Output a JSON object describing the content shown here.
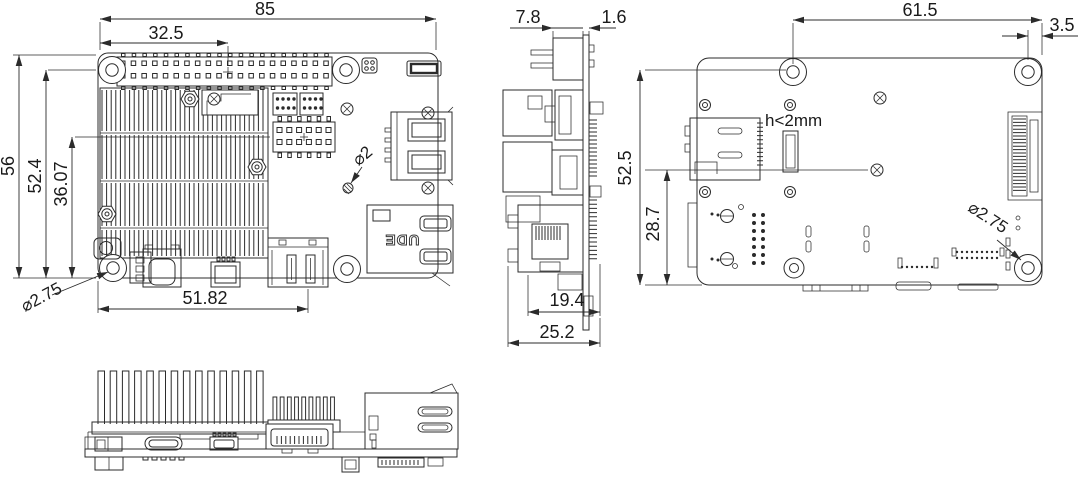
{
  "drawing": {
    "top_view": {
      "width": "85",
      "gpio_center_offset": "32.5",
      "board_height": "56",
      "hole_row_offset": "52.4",
      "header_row_offset": "36.07",
      "hdmi_center_offset": "51.82",
      "via_diameter": "⌀2",
      "mounting_hole_diameter": "⌀2.75"
    },
    "side_view": {
      "gpio_header_depth": "7.8",
      "pcb_thickness": "1.6",
      "ethernet_depth": "19.4",
      "overall_depth": "25.2"
    },
    "bottom_view": {
      "hole_to_edge_span": "61.5",
      "hole_edge_margin": "3.5",
      "hole_row_span": "52.5",
      "sd_row_offset": "28.7",
      "component_height_note": "h<2mm",
      "mounting_hole_diameter": "⌀2.75"
    },
    "ethernet_marking": "UDE"
  }
}
